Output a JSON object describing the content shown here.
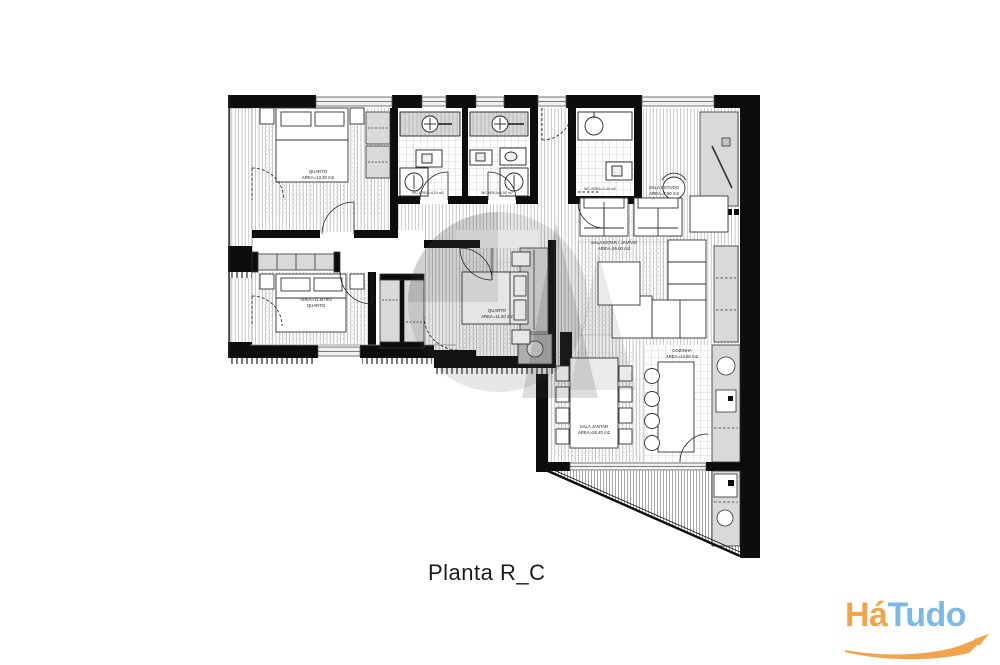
{
  "caption": "Planta R_C",
  "plan": {
    "rooms": {
      "quarto1": {
        "name": "QUARTO",
        "area": "AREA=13.20 m2"
      },
      "quarto2": {
        "name": "QUARTO",
        "area": "AREA=11.60 m2"
      },
      "quarto3": {
        "name": "QUARTO",
        "area": "AREA=11.00 m2"
      },
      "wc1": {
        "label": "WC AREA=4.10 m2"
      },
      "wc2": {
        "label": "WC AREA=4.50 m2"
      },
      "wc3": {
        "label": "WC AREA=2.40 m2"
      },
      "estudo": {
        "name": "SALA ESTUDO",
        "area": "AREA=7.50 m2"
      },
      "estar": {
        "name": "SALA ESTAR / JANTAR",
        "area": "AREA=26.00 m2"
      },
      "jantar": {
        "name": "SALA JANTAR",
        "area": "AREA=28.40 m2"
      },
      "cozinha": {
        "name": "COZINHA",
        "area": "AREA=13.60 m2"
      }
    }
  },
  "logo": {
    "part1": "Há",
    "part2": "Tudo",
    "part1_color": "#F2A44C",
    "part2_color": "#7EB9E4",
    "swoosh_color": "#F2A44C"
  },
  "colors": {
    "wall": "#0d0d0d",
    "cabinet_fill": "#d9d9d9",
    "floor_hatch": "#9a9a9a",
    "watermark": "#3c3c3c"
  }
}
